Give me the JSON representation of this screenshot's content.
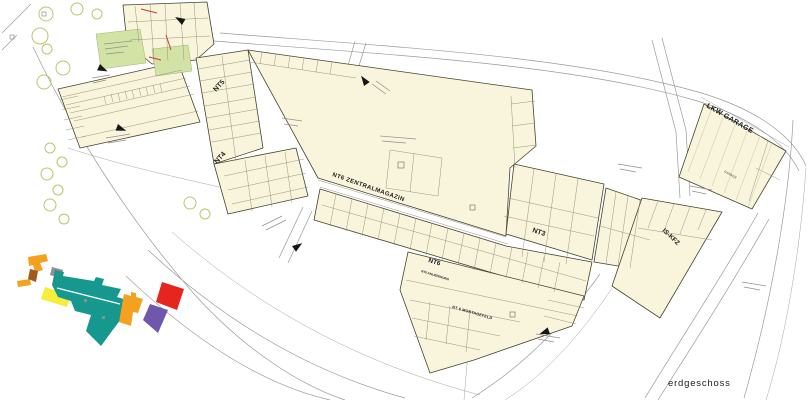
{
  "page": {
    "background": "#ffffff",
    "floor_label": "erdgeschoss"
  },
  "colors": {
    "building_fill": "#f8f5dc",
    "green_area": "#d3e3a6",
    "tree_stroke": "#b5c96a",
    "wall": "#45422f",
    "partition": "#8c8974",
    "road": "#9a9a9a",
    "accent_red": "#cf3a2a",
    "arrow_black": "#161616",
    "hatch": "#d9d5b8",
    "floor_text": "#8b95a1",
    "label_text": "#1c1c1c",
    "key_teal": "#17988f",
    "key_orange": "#f4a11f",
    "key_yellow": "#f6ee3a",
    "key_red": "#e6251e",
    "key_purple": "#7057ae",
    "key_brown": "#a05a1e",
    "key_mauve": "#988a94",
    "key_gray": "#8f8f8f"
  },
  "labels": {
    "nt5": "NT5",
    "nt4": "NT4",
    "nt3": "NT3",
    "nt6": "NT6",
    "nt6_sub": "NT6 ANLIEFERUNG",
    "zentralmagazin": "NT6 ZENTRALMAGAZIN",
    "montagefeld": "NT 6 MONTAGEFELD",
    "lkw_garage": "LKW GARAGE",
    "garage_room": "GARAGE",
    "is_kfz": "IS-KFZ",
    "floor": "erdgeschoss"
  },
  "key_plan": {
    "parts": [
      {
        "name": "left-complex",
        "color": "#f4a11f"
      },
      {
        "name": "left-annex",
        "color": "#a05a1e"
      },
      {
        "name": "nt5-wing",
        "color": "#988a94"
      },
      {
        "name": "nt4-wing",
        "color": "#f6ee3a"
      },
      {
        "name": "central-band",
        "color": "#17988f"
      },
      {
        "name": "east-block",
        "color": "#f4a11f"
      },
      {
        "name": "lkw-garage",
        "color": "#e6251e"
      },
      {
        "name": "is-kfz",
        "color": "#7057ae"
      }
    ]
  }
}
